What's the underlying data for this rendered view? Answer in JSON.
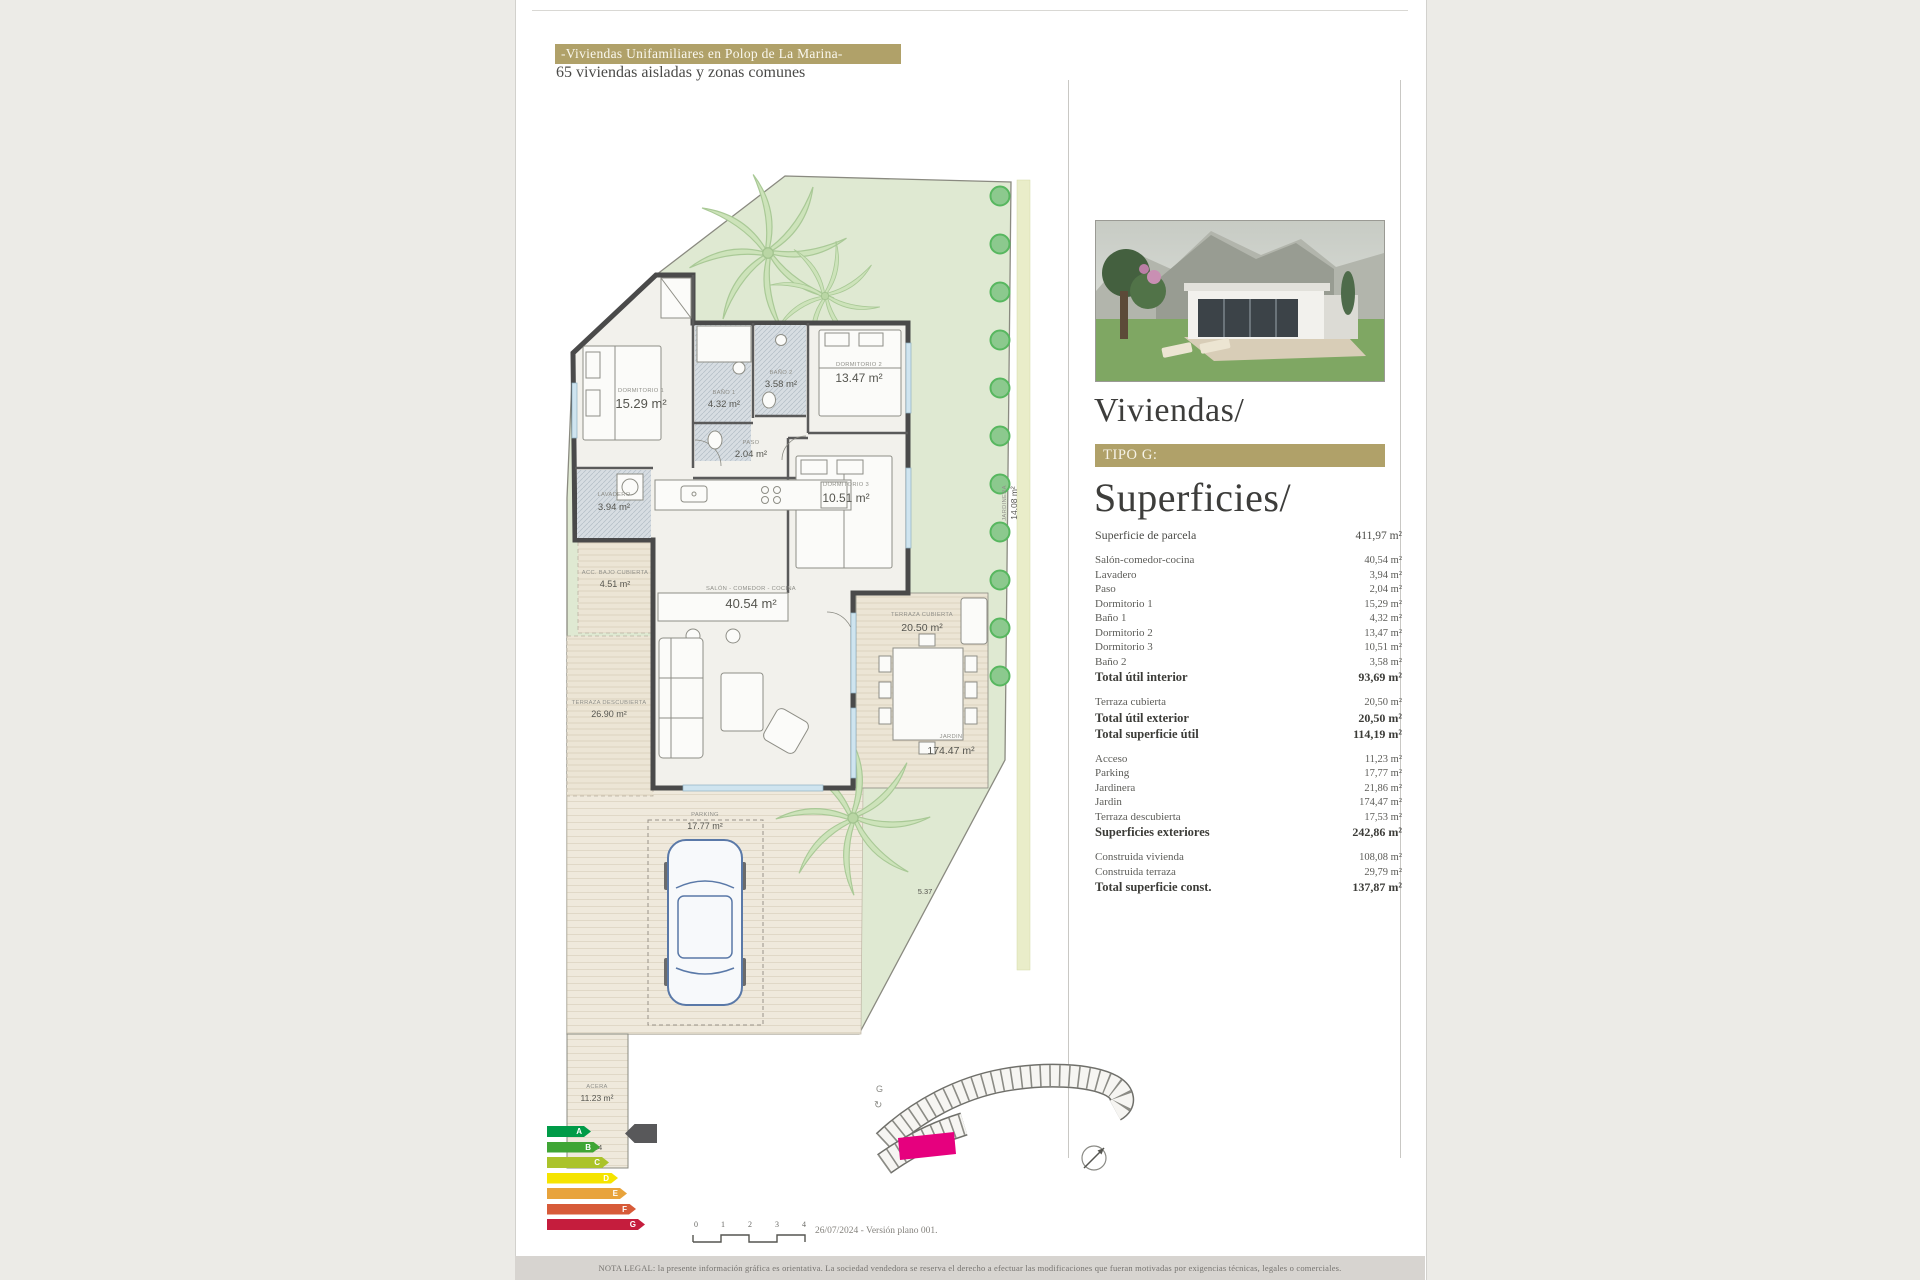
{
  "header": {
    "title": "-Viviendas Unifamiliares en Polop de La Marina-",
    "subtitle": "65 viviendas aisladas y zonas comunes"
  },
  "panel": {
    "heading": "Viviendas/",
    "tipo_label": "TIPO G:",
    "superficies_heading": "Superficies/",
    "rows": [
      {
        "label": "Superficie de parcela",
        "value": "411,97 m²",
        "cls": "parcela"
      },
      {
        "label": "Salón-comedor-cocina",
        "value": "40,54 m²",
        "cls": ""
      },
      {
        "label": "Lavadero",
        "value": "3,94 m²",
        "cls": ""
      },
      {
        "label": "Paso",
        "value": "2,04 m²",
        "cls": ""
      },
      {
        "label": "Dormitorio 1",
        "value": "15,29 m²",
        "cls": ""
      },
      {
        "label": "Baño 1",
        "value": "4,32 m²",
        "cls": ""
      },
      {
        "label": "Dormitorio 2",
        "value": "13,47 m²",
        "cls": ""
      },
      {
        "label": "Dormitorio 3",
        "value": "10,51 m²",
        "cls": ""
      },
      {
        "label": "Baño 2",
        "value": "3,58 m²",
        "cls": ""
      },
      {
        "label": "Total útil interior",
        "value": "93,69 m²",
        "cls": "total"
      },
      {
        "label": "Terraza cubierta",
        "value": "20,50 m²",
        "cls": "gap"
      },
      {
        "label": "Total útil exterior",
        "value": "20,50 m²",
        "cls": "total"
      },
      {
        "label": "Total superficie útil",
        "value": "114,19 m²",
        "cls": "total"
      },
      {
        "label": "Acceso",
        "value": "11,23 m²",
        "cls": "gap"
      },
      {
        "label": "Parking",
        "value": "17,77 m²",
        "cls": ""
      },
      {
        "label": "Jardinera",
        "value": "21,86 m²",
        "cls": ""
      },
      {
        "label": "Jardin",
        "value": "174,47 m²",
        "cls": ""
      },
      {
        "label": "Terraza descubierta",
        "value": "17,53 m²",
        "cls": ""
      },
      {
        "label": "Superficies exteriores",
        "value": "242,86 m²",
        "cls": "total"
      },
      {
        "label": "Construida vivienda",
        "value": "108,08 m²",
        "cls": "gap"
      },
      {
        "label": "Construida terraza",
        "value": "29,79 m²",
        "cls": ""
      },
      {
        "label": "Total superficie const.",
        "value": "137,87 m²",
        "cls": "total"
      }
    ]
  },
  "plan": {
    "rooms": [
      {
        "name": "DORMITORIO 1",
        "area": "15.29 m²"
      },
      {
        "name": "BAÑO 1",
        "area": "4.32 m²"
      },
      {
        "name": "BAÑO 2",
        "area": "3.58 m²"
      },
      {
        "name": "PASO",
        "area": "2.04 m²"
      },
      {
        "name": "DORMITORIO 2",
        "area": "13.47 m²"
      },
      {
        "name": "DORMITORIO 3",
        "area": "10.51 m²"
      },
      {
        "name": "LAVADERO",
        "area": "3.94 m²"
      },
      {
        "name": "SALÓN - COMEDOR - COCINA",
        "area": "40.54 m²"
      },
      {
        "name": "TERRAZA CUBIERTA",
        "area": "20.50 m²"
      },
      {
        "name": "TERRAZA DESCUBIERTA",
        "area": "26.90 m²"
      },
      {
        "name": "ACC. BAJO CUBIERTA",
        "area": "4.51 m²"
      },
      {
        "name": "JARDIN",
        "area": "174.47 m²"
      },
      {
        "name": "JARDINERA",
        "area": "14.08 m²"
      },
      {
        "name": "PARKING",
        "area": "17.77 m²"
      },
      {
        "name": "ACERA",
        "area": "11.23 m²"
      }
    ],
    "dims": {
      "a": "2.4",
      "b": "5.37"
    }
  },
  "site_plan": {
    "marker": "G",
    "rotate_icon": "↻"
  },
  "energy": {
    "grades": [
      {
        "letter": "A",
        "color": "#009b48",
        "w": 44
      },
      {
        "letter": "B",
        "color": "#3fa535",
        "w": 53
      },
      {
        "letter": "C",
        "color": "#abc32a",
        "w": 62
      },
      {
        "letter": "D",
        "color": "#f5e400",
        "w": 71
      },
      {
        "letter": "E",
        "color": "#e8a33b",
        "w": 80
      },
      {
        "letter": "F",
        "color": "#d75b39",
        "w": 89
      },
      {
        "letter": "G",
        "color": "#c51d3d",
        "w": 98
      }
    ]
  },
  "footer": {
    "scale_ticks": [
      {
        "t": "0"
      },
      {
        "t": "1"
      },
      {
        "t": "2"
      },
      {
        "t": "3"
      },
      {
        "t": "4"
      }
    ],
    "version_note": "26/07/2024 - Versión plano 001.",
    "legal": "NOTA LEGAL: la presente información gráfica es orientativa. La sociedad vendedora se reserva el derecho a efectuar las modificaciones que fueran motivadas por exigencias técnicas, legales o comerciales."
  },
  "colors": {
    "accent_gold": "#b0a169",
    "parcel_green": "#dfe9d2",
    "highlight_magenta": "#e6007e"
  }
}
